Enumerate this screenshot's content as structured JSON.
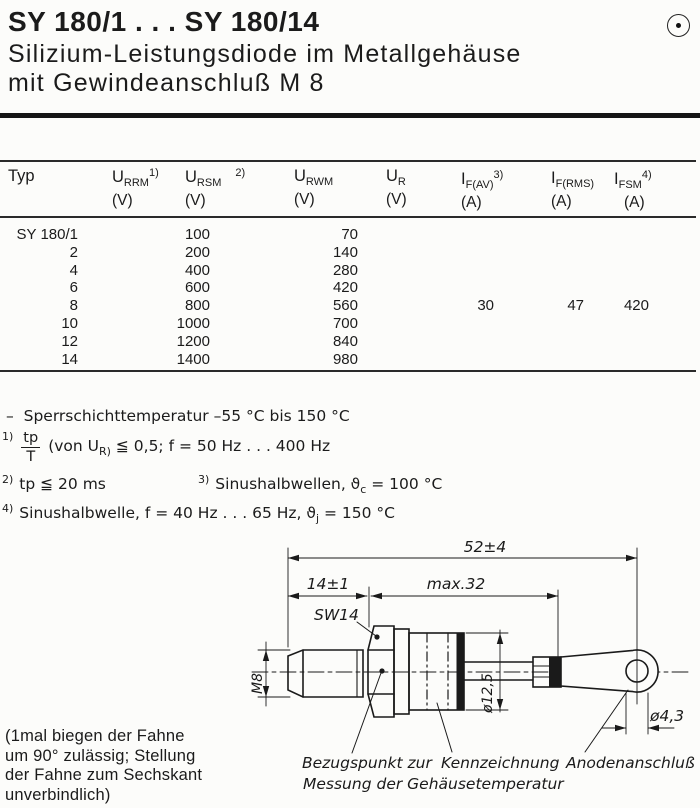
{
  "header": {
    "title": "SY 180/1 . . . SY 180/14",
    "subtitle_line1": "Silizium-Leistungsdiode im Metallgehäuse",
    "subtitle_line2": "mit Gewindeanschluß M 8",
    "corner_icon": "circled-dot"
  },
  "table": {
    "col_typ": {
      "label": "Typ"
    },
    "col_urrm": {
      "base": "U",
      "sub": "RRM",
      "sup": "1)",
      "unit": "(V)"
    },
    "col_ursm": {
      "base": "U",
      "sub": "RSM",
      "sup": "2)",
      "unit": "(V)"
    },
    "col_urwm": {
      "base": "U",
      "sub": "RWM",
      "unit": "(V)"
    },
    "col_ur": {
      "base": "U",
      "sub": "R",
      "unit": "(V)"
    },
    "col_ifav": {
      "base": "I",
      "sub": "F(AV)",
      "sup": "3)",
      "unit": "(A)"
    },
    "col_ifrms": {
      "base": "I",
      "sub": "F(RMS)",
      "unit": "(A)"
    },
    "col_ifsm": {
      "base": "I",
      "sub": "FSM",
      "sup": "4)",
      "unit": "(A)"
    },
    "rows": [
      {
        "typ": "SY 180/1",
        "urrm": "100",
        "urwm": "70",
        "ifav": "",
        "ifrms": "",
        "ifsm": ""
      },
      {
        "typ": "2",
        "urrm": "200",
        "urwm": "140",
        "ifav": "",
        "ifrms": "",
        "ifsm": ""
      },
      {
        "typ": "4",
        "urrm": "400",
        "urwm": "280",
        "ifav": "",
        "ifrms": "",
        "ifsm": ""
      },
      {
        "typ": "6",
        "urrm": "600",
        "urwm": "420",
        "ifav": "",
        "ifrms": "",
        "ifsm": ""
      },
      {
        "typ": "8",
        "urrm": "800",
        "urwm": "560",
        "ifav": "30",
        "ifrms": "47",
        "ifsm": "420"
      },
      {
        "typ": "10",
        "urrm": "1000",
        "urwm": "700",
        "ifav": "",
        "ifrms": "",
        "ifsm": ""
      },
      {
        "typ": "12",
        "urrm": "1200",
        "urwm": "840",
        "ifav": "",
        "ifrms": "",
        "ifsm": ""
      },
      {
        "typ": "14",
        "urrm": "1400",
        "urwm": "980",
        "ifav": "",
        "ifrms": "",
        "ifsm": ""
      }
    ]
  },
  "notes": {
    "temp_dash": "–",
    "temp_text": "Sperrschichttemperatur  –55 °C bis 150 °C",
    "n1_sup": "1)",
    "n1_num": "tp",
    "n1_den": "T",
    "n1_pre": "(von U",
    "n1_sub": "R)",
    "n1_post": " ≦ 0,5;  f = 50 Hz . . . 400 Hz",
    "n2_sup": "2)",
    "n2_text": "tp ≦ 20 ms",
    "n3_sup": "3)",
    "n3_pre": "Sinushalbwellen,  ϑ",
    "n3_sub": "c",
    "n3_post": " = 100 °C",
    "n4_sup": "4)",
    "n4_pre": "Sinushalbwelle,  f = 40 Hz . . . 65 Hz,  ϑ",
    "n4_sub": "j",
    "n4_post": " = 150 °C"
  },
  "drawing": {
    "dim_overall": "52±4",
    "dim_stud": "14±1",
    "dim_body": "max.32",
    "hex_size": "SW14",
    "thread": "M8",
    "dia_body": "ø12,5",
    "dia_hole": "ø4,3",
    "label_ref_1": "Bezugspunkt zur",
    "label_ref_2": "Messung der Gehäusetemperatur",
    "label_marking": "Kennzeichnung",
    "label_anode": "Anodenanschluß"
  },
  "footnote": {
    "line1": "(1mal biegen der Fahne",
    "line2": "um 90° zulässig; Stellung",
    "line3": "der Fahne zum Sechskant",
    "line4": "unverbindlich)"
  }
}
